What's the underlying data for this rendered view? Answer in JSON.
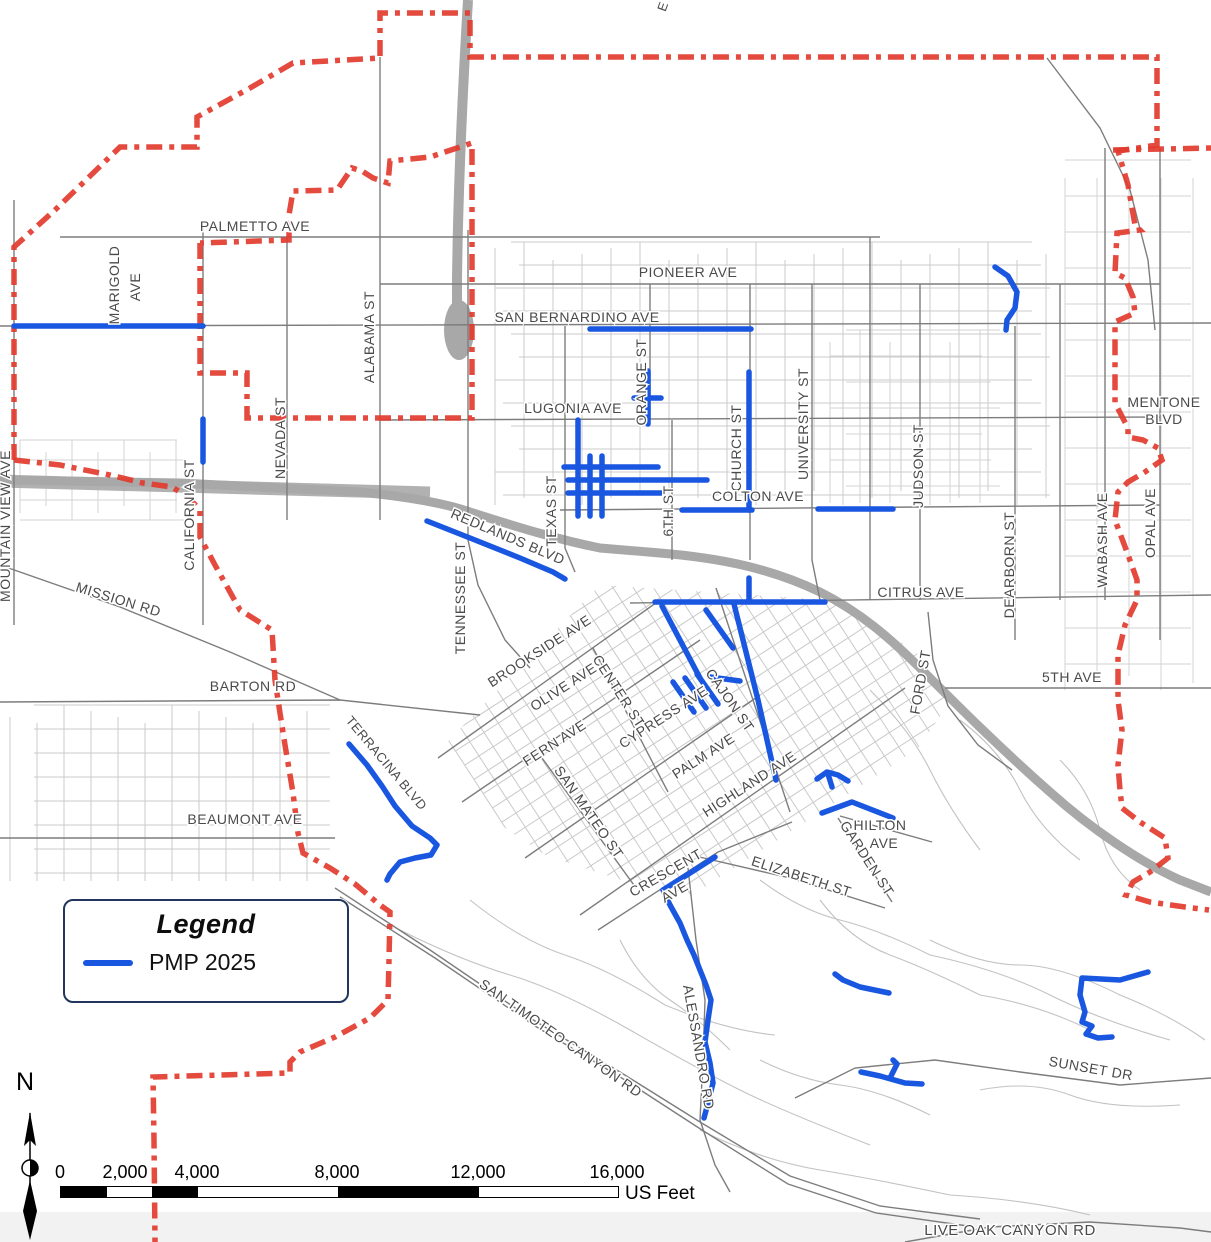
{
  "legend": {
    "title": "Legend",
    "items": [
      {
        "label": "PMP 2025",
        "color": "#1957e0"
      }
    ]
  },
  "scale_bar": {
    "labels": [
      "0",
      "2,000",
      "4,000",
      "8,000",
      "12,000",
      "16,000"
    ],
    "unit": "US Feet"
  },
  "north_arrow": {
    "label": "N"
  },
  "colors": {
    "pmp": "#1957e0",
    "boundary": "#e23b2e",
    "freeway": "#a8a8a8",
    "road_major": "#7d7d7d",
    "road_minor": "#c9c9c9",
    "label": "#4a4a4a"
  },
  "street_labels": [
    {
      "text": "PALMETTO AVE",
      "x": 255,
      "y": 231,
      "rot": 0,
      "size": 14
    },
    {
      "text": "MARIGOLD",
      "x": 119,
      "y": 285,
      "rot": -90,
      "size": 14
    },
    {
      "text": "AVE",
      "x": 140,
      "y": 287,
      "rot": -90,
      "size": 14
    },
    {
      "text": "PIONEER AVE",
      "x": 688,
      "y": 277,
      "rot": 0,
      "size": 14
    },
    {
      "text": "SAN BERNARDINO AVE",
      "x": 577,
      "y": 322,
      "rot": 0,
      "size": 14
    },
    {
      "text": "ALABAMA ST",
      "x": 374,
      "y": 337,
      "rot": -90,
      "size": 14
    },
    {
      "text": "LUGONIA AVE",
      "x": 573,
      "y": 413,
      "rot": 0,
      "size": 14
    },
    {
      "text": "ORANGE ST",
      "x": 646,
      "y": 382,
      "rot": -90,
      "size": 14
    },
    {
      "text": "NEVADA ST",
      "x": 285,
      "y": 438,
      "rot": -90,
      "size": 14
    },
    {
      "text": "CALIFORNIA ST",
      "x": 194,
      "y": 515,
      "rot": -90,
      "size": 14
    },
    {
      "text": "MOUNTAIN VIEW AVE",
      "x": 10,
      "y": 526,
      "rot": -90,
      "size": 14
    },
    {
      "text": "MENTONE",
      "x": 1164,
      "y": 407,
      "rot": 0,
      "size": 14
    },
    {
      "text": "BLVD",
      "x": 1164,
      "y": 424,
      "rot": 0,
      "size": 14
    },
    {
      "text": "CHURCH ST",
      "x": 741,
      "y": 448,
      "rot": -90,
      "size": 14
    },
    {
      "text": "UNIVERSITY ST",
      "x": 808,
      "y": 424,
      "rot": -90,
      "size": 14
    },
    {
      "text": "JUDSON ST",
      "x": 923,
      "y": 466,
      "rot": -90,
      "size": 14
    },
    {
      "text": "WABASH AVE",
      "x": 1107,
      "y": 540,
      "rot": -90,
      "size": 14
    },
    {
      "text": "OPAL AVE",
      "x": 1155,
      "y": 523,
      "rot": -90,
      "size": 14
    },
    {
      "text": "MISSION RD",
      "x": 117,
      "y": 604,
      "rot": 17,
      "size": 14
    },
    {
      "text": "TEXAS ST",
      "x": 556,
      "y": 511,
      "rot": -90,
      "size": 14
    },
    {
      "text": "TENNESSEE ST",
      "x": 465,
      "y": 598,
      "rot": -90,
      "size": 14
    },
    {
      "text": "REDLANDS BLVD",
      "x": 506,
      "y": 541,
      "rot": 23,
      "size": 14
    },
    {
      "text": "6TH ST",
      "x": 673,
      "y": 511,
      "rot": -90,
      "size": 14
    },
    {
      "text": "COLTON AVE",
      "x": 758,
      "y": 501,
      "rot": 0,
      "size": 14
    },
    {
      "text": "CITRUS AVE",
      "x": 921,
      "y": 597,
      "rot": 0,
      "size": 14
    },
    {
      "text": "DEARBORN ST",
      "x": 1014,
      "y": 565,
      "rot": -90,
      "size": 14
    },
    {
      "text": "BARTON RD",
      "x": 253,
      "y": 691,
      "rot": 0,
      "size": 14
    },
    {
      "text": "BROOKSIDE AVE",
      "x": 542,
      "y": 655,
      "rot": -33,
      "size": 14
    },
    {
      "text": "OLIVE AVE",
      "x": 566,
      "y": 691,
      "rot": -33,
      "size": 14
    },
    {
      "text": "CENTER ST",
      "x": 615,
      "y": 694,
      "rot": 57,
      "size": 14
    },
    {
      "text": "FERN AVE",
      "x": 557,
      "y": 747,
      "rot": -33,
      "size": 14
    },
    {
      "text": "CYPRESS AVE",
      "x": 666,
      "y": 721,
      "rot": -33,
      "size": 14
    },
    {
      "text": "SAN MATEO ST",
      "x": 585,
      "y": 815,
      "rot": 55,
      "size": 14
    },
    {
      "text": "PALM AVE",
      "x": 706,
      "y": 760,
      "rot": -33,
      "size": 14
    },
    {
      "text": "CAJON ST",
      "x": 726,
      "y": 703,
      "rot": 55,
      "size": 14
    },
    {
      "text": "HIGHLAND AVE",
      "x": 752,
      "y": 788,
      "rot": -33,
      "size": 14
    },
    {
      "text": "FORD ST",
      "x": 925,
      "y": 683,
      "rot": -80,
      "size": 14
    },
    {
      "text": "5TH AVE",
      "x": 1072,
      "y": 682,
      "rot": 0,
      "size": 14
    },
    {
      "text": "TERRACINA BLVD",
      "x": 383,
      "y": 766,
      "rot": 50,
      "size": 13
    },
    {
      "text": "BEAUMONT AVE",
      "x": 245,
      "y": 824,
      "rot": 0,
      "size": 14
    },
    {
      "text": "HILTON",
      "x": 880,
      "y": 830,
      "rot": 0,
      "size": 14
    },
    {
      "text": "AVE",
      "x": 884,
      "y": 848,
      "rot": 0,
      "size": 14
    },
    {
      "text": "GARDEN ST",
      "x": 863,
      "y": 861,
      "rot": 57,
      "size": 14
    },
    {
      "text": "CRESCENT",
      "x": 668,
      "y": 877,
      "rot": -30,
      "size": 14
    },
    {
      "text": "AVE",
      "x": 677,
      "y": 896,
      "rot": -30,
      "size": 14
    },
    {
      "text": "ELIZABETH ST",
      "x": 800,
      "y": 881,
      "rot": 18,
      "size": 14
    },
    {
      "text": "SAN TIMOTEO CANYON RD",
      "x": 558,
      "y": 1042,
      "rot": 35,
      "size": 14
    },
    {
      "text": "ALESSANDRO RD",
      "x": 694,
      "y": 1048,
      "rot": 80,
      "size": 14
    },
    {
      "text": "SUNSET DR",
      "x": 1090,
      "y": 1073,
      "rot": 10,
      "size": 14
    },
    {
      "text": "LIVE OAK CANYON RD",
      "x": 1010,
      "y": 1235,
      "rot": 0,
      "size": 15
    },
    {
      "text": "E",
      "x": 667,
      "y": 8,
      "rot": -70,
      "size": 13
    }
  ],
  "boundary_paths": [
    [
      [
        14,
        460
      ],
      [
        14,
        247
      ],
      [
        55,
        210
      ],
      [
        120,
        147
      ],
      [
        197,
        147
      ],
      [
        197,
        117
      ],
      [
        250,
        88
      ],
      [
        293,
        63
      ],
      [
        380,
        58
      ],
      [
        380,
        13
      ],
      [
        470,
        13
      ],
      [
        470,
        57
      ],
      [
        1157,
        57
      ],
      [
        1157,
        145
      ],
      [
        1118,
        151
      ],
      [
        1128,
        185
      ],
      [
        1135,
        225
      ],
      [
        1140,
        230
      ],
      [
        1117,
        233
      ],
      [
        1115,
        273
      ],
      [
        1125,
        278
      ],
      [
        1133,
        297
      ],
      [
        1135,
        313
      ],
      [
        1115,
        322
      ],
      [
        1115,
        403
      ],
      [
        1128,
        428
      ],
      [
        1128,
        437
      ],
      [
        1143,
        440
      ],
      [
        1158,
        448
      ],
      [
        1162,
        460
      ],
      [
        1145,
        472
      ],
      [
        1128,
        482
      ],
      [
        1118,
        492
      ],
      [
        1115,
        520
      ],
      [
        1127,
        552
      ],
      [
        1137,
        580
      ],
      [
        1137,
        600
      ],
      [
        1125,
        625
      ],
      [
        1118,
        655
      ],
      [
        1118,
        700
      ],
      [
        1122,
        730
      ],
      [
        1118,
        765
      ],
      [
        1120,
        790
      ],
      [
        1122,
        808
      ],
      [
        1140,
        822
      ],
      [
        1165,
        838
      ],
      [
        1168,
        858
      ],
      [
        1150,
        872
      ],
      [
        1133,
        882
      ],
      [
        1126,
        895
      ],
      [
        1150,
        902
      ],
      [
        1185,
        907
      ],
      [
        1209,
        910
      ]
    ],
    [
      [
        1113,
        150
      ],
      [
        1211,
        148
      ]
    ],
    [
      [
        200,
        243
      ],
      [
        200,
        373
      ],
      [
        247,
        373
      ],
      [
        247,
        418
      ],
      [
        472,
        418
      ],
      [
        472,
        143
      ],
      [
        430,
        157
      ],
      [
        390,
        161
      ],
      [
        388,
        183
      ],
      [
        373,
        178
      ],
      [
        362,
        171
      ],
      [
        352,
        168
      ],
      [
        337,
        190
      ],
      [
        293,
        191
      ],
      [
        289,
        215
      ],
      [
        289,
        240
      ],
      [
        200,
        243
      ]
    ],
    [
      [
        14,
        460
      ],
      [
        60,
        465
      ],
      [
        110,
        475
      ],
      [
        143,
        483
      ],
      [
        172,
        487
      ],
      [
        188,
        497
      ],
      [
        200,
        510
      ],
      [
        200,
        537
      ],
      [
        215,
        565
      ],
      [
        240,
        610
      ],
      [
        272,
        630
      ],
      [
        275,
        680
      ],
      [
        280,
        713
      ],
      [
        285,
        745
      ],
      [
        293,
        793
      ],
      [
        298,
        833
      ],
      [
        303,
        853
      ],
      [
        330,
        868
      ],
      [
        355,
        884
      ],
      [
        380,
        905
      ],
      [
        390,
        912
      ],
      [
        389,
        960
      ],
      [
        388,
        1000
      ],
      [
        370,
        1018
      ],
      [
        335,
        1037
      ],
      [
        300,
        1052
      ],
      [
        290,
        1062
      ],
      [
        290,
        1073
      ],
      [
        153,
        1077
      ],
      [
        154,
        1140
      ],
      [
        155,
        1242
      ]
    ]
  ],
  "pmp_segments": [
    [
      [
        14,
        326
      ],
      [
        203,
        326
      ]
    ],
    [
      [
        203,
        419
      ],
      [
        203,
        462
      ]
    ],
    [
      [
        590,
        329
      ],
      [
        751,
        329
      ]
    ],
    [
      [
        995,
        267
      ],
      [
        1008,
        276
      ],
      [
        1017,
        292
      ],
      [
        1015,
        308
      ],
      [
        1007,
        320
      ],
      [
        1006,
        330
      ]
    ],
    [
      [
        648,
        371
      ],
      [
        648,
        424
      ]
    ],
    [
      [
        634,
        398
      ],
      [
        661,
        398
      ]
    ],
    [
      [
        578,
        420
      ],
      [
        578,
        516
      ]
    ],
    [
      [
        590,
        456
      ],
      [
        590,
        516
      ]
    ],
    [
      [
        602,
        456
      ],
      [
        602,
        516
      ]
    ],
    [
      [
        564,
        467
      ],
      [
        658,
        467
      ]
    ],
    [
      [
        568,
        480
      ],
      [
        707,
        480
      ]
    ],
    [
      [
        568,
        493
      ],
      [
        661,
        493
      ]
    ],
    [
      [
        749,
        372
      ],
      [
        749,
        510
      ]
    ],
    [
      [
        682,
        510
      ],
      [
        752,
        510
      ]
    ],
    [
      [
        818,
        509
      ],
      [
        893,
        509
      ]
    ],
    [
      [
        427,
        521
      ],
      [
        470,
        538
      ],
      [
        520,
        558
      ],
      [
        553,
        572
      ],
      [
        565,
        579
      ]
    ],
    [
      [
        655,
        602
      ],
      [
        825,
        602
      ]
    ],
    [
      [
        749,
        578
      ],
      [
        749,
        602
      ]
    ],
    [
      [
        662,
        606
      ],
      [
        700,
        678
      ]
    ],
    [
      [
        706,
        610
      ],
      [
        733,
        648
      ]
    ],
    [
      [
        673,
        682
      ],
      [
        694,
        712
      ]
    ],
    [
      [
        685,
        678
      ],
      [
        706,
        708
      ]
    ],
    [
      [
        697,
        674
      ],
      [
        718,
        704
      ]
    ],
    [
      [
        734,
        604
      ],
      [
        758,
        700
      ],
      [
        776,
        780
      ]
    ],
    [
      [
        710,
        677
      ],
      [
        740,
        681
      ]
    ],
    [
      [
        349,
        744
      ],
      [
        367,
        765
      ],
      [
        382,
        786
      ],
      [
        395,
        806
      ],
      [
        412,
        826
      ],
      [
        430,
        838
      ],
      [
        437,
        845
      ],
      [
        431,
        855
      ],
      [
        415,
        858
      ],
      [
        400,
        862
      ],
      [
        390,
        874
      ],
      [
        387,
        880
      ]
    ],
    [
      [
        715,
        857
      ],
      [
        690,
        873
      ],
      [
        663,
        890
      ],
      [
        670,
        905
      ],
      [
        680,
        923
      ],
      [
        687,
        940
      ],
      [
        694,
        955
      ],
      [
        700,
        970
      ],
      [
        706,
        985
      ],
      [
        711,
        1000
      ],
      [
        708,
        1020
      ],
      [
        705,
        1042
      ],
      [
        710,
        1063
      ],
      [
        713,
        1083
      ],
      [
        708,
        1103
      ],
      [
        704,
        1118
      ]
    ],
    [
      [
        817,
        779
      ],
      [
        827,
        772
      ],
      [
        838,
        775
      ],
      [
        848,
        781
      ]
    ],
    [
      [
        828,
        774
      ],
      [
        832,
        787
      ]
    ],
    [
      [
        822,
        813
      ],
      [
        852,
        802
      ],
      [
        893,
        818
      ]
    ],
    [
      [
        835,
        974
      ],
      [
        843,
        980
      ],
      [
        860,
        987
      ],
      [
        889,
        993
      ]
    ],
    [
      [
        861,
        1072
      ],
      [
        880,
        1076
      ],
      [
        905,
        1083
      ],
      [
        922,
        1084
      ]
    ],
    [
      [
        890,
        1078
      ],
      [
        897,
        1064
      ],
      [
        893,
        1060
      ]
    ],
    [
      [
        1148,
        972
      ],
      [
        1120,
        980
      ],
      [
        1082,
        978
      ],
      [
        1080,
        995
      ],
      [
        1085,
        1012
      ],
      [
        1082,
        1022
      ],
      [
        1092,
        1026
      ],
      [
        1086,
        1034
      ],
      [
        1098,
        1038
      ],
      [
        1112,
        1037
      ]
    ]
  ]
}
